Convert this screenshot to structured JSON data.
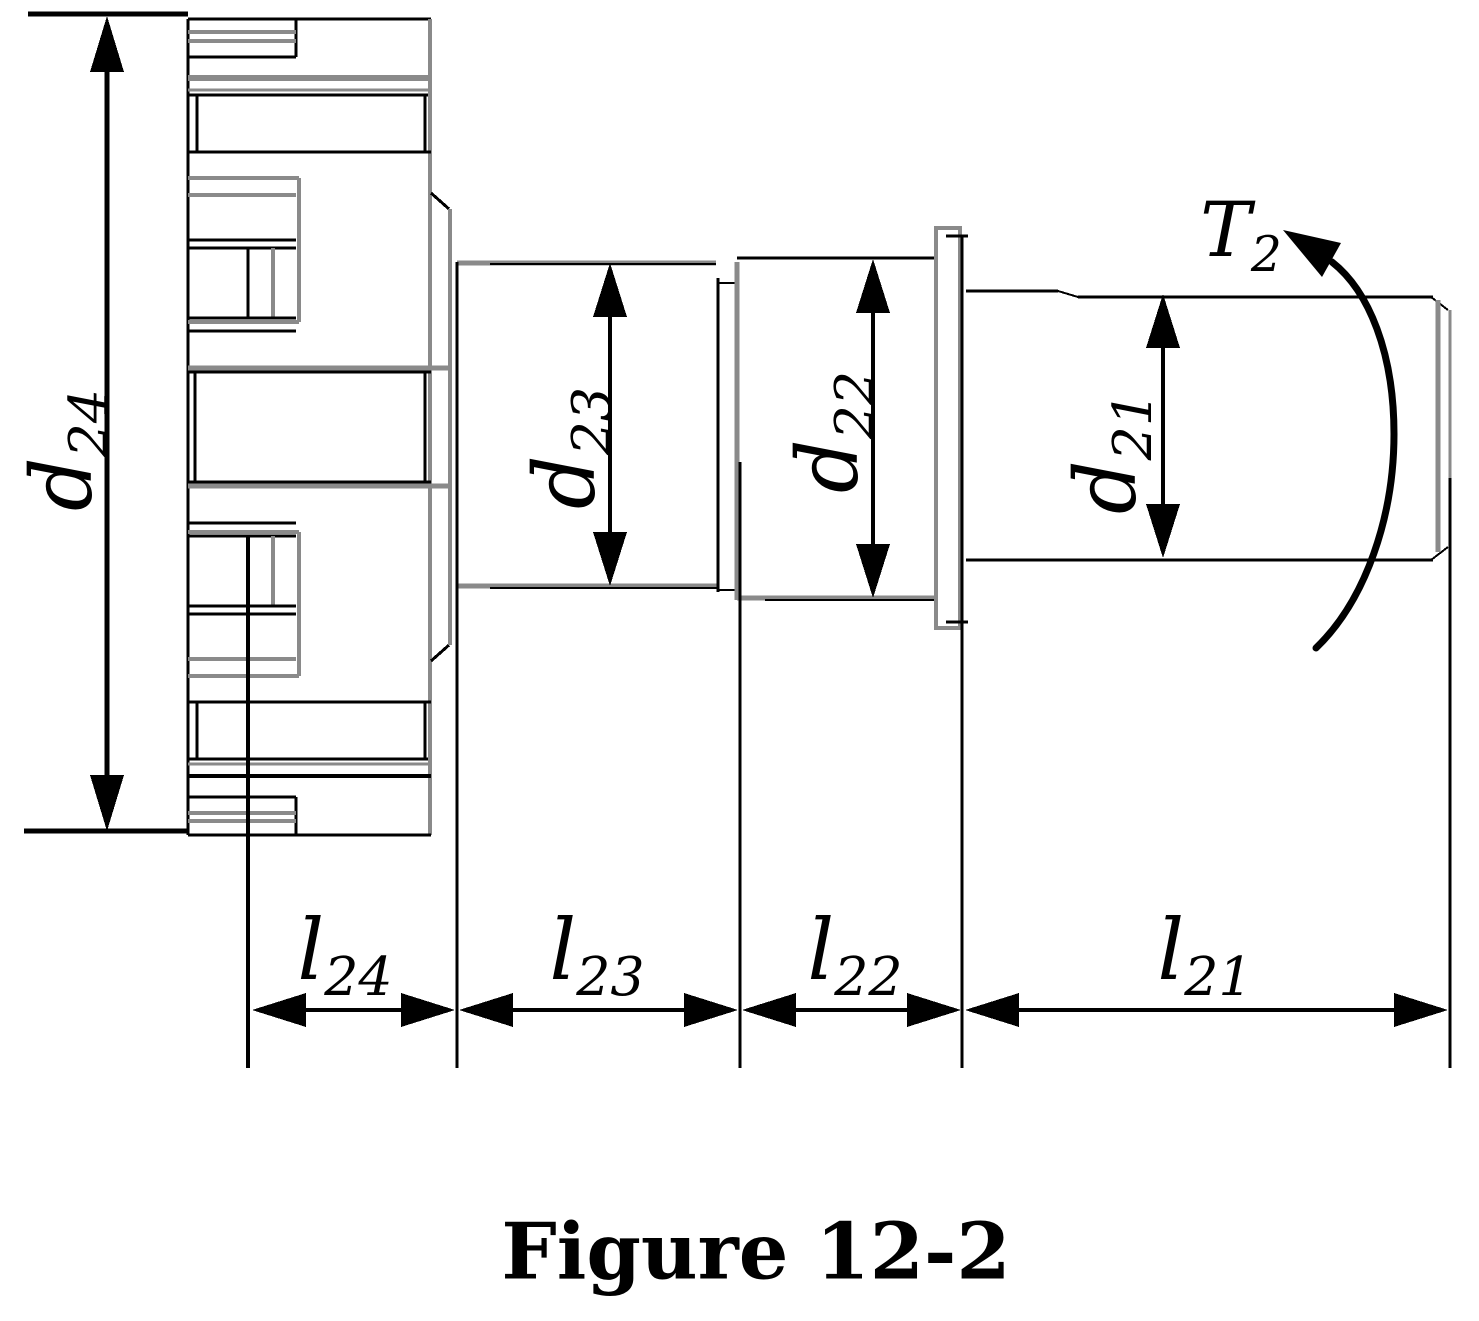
{
  "caption": "Figure 12-2",
  "labels": {
    "d24": {
      "base": "d",
      "sub": "24"
    },
    "d23": {
      "base": "d",
      "sub": "23"
    },
    "d22": {
      "base": "d",
      "sub": "22"
    },
    "d21": {
      "base": "d",
      "sub": "21"
    },
    "l24": {
      "base": "l",
      "sub": "24"
    },
    "l23": {
      "base": "l",
      "sub": "23"
    },
    "l22": {
      "base": "l",
      "sub": "22"
    },
    "l21": {
      "base": "l",
      "sub": "21"
    },
    "torque": {
      "base": "T",
      "sub": "2"
    }
  },
  "colors": {
    "ink": "#000000",
    "line_gray": "#8a8a8a",
    "background": "#ffffff"
  }
}
